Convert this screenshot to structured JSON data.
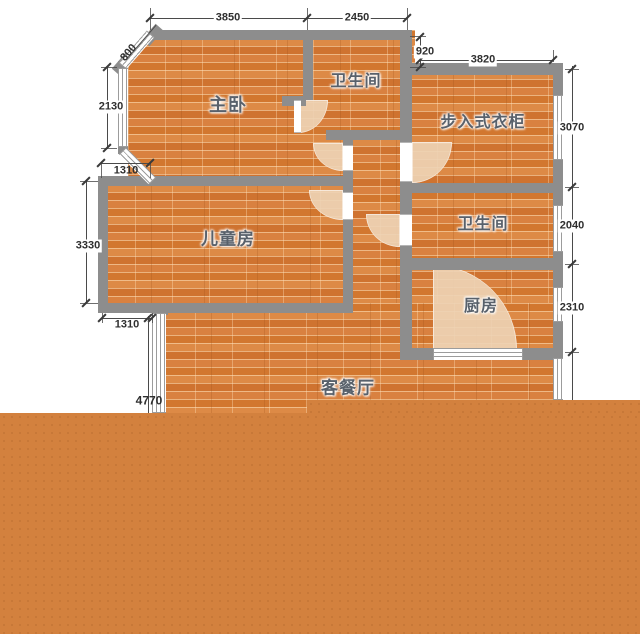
{
  "rooms": {
    "master_bedroom": "主卧",
    "bath_top": "卫生间",
    "closet": "步入式衣柜",
    "kids_room": "儿童房",
    "bath_mid": "卫生间",
    "kitchen": "厨房",
    "living_dining": "客餐厅"
  },
  "dimensions": {
    "top_left": "3850",
    "top_right": "2450",
    "right_offset": "920",
    "closet_width": "3820",
    "closet_height": "3070",
    "bath_height": "2040",
    "kitchen_height": "2310",
    "chamfer_window": "800",
    "master_window": "2130",
    "kids_top_offset": "1310",
    "kids_height": "3330",
    "kids_bottom_offset": "1310",
    "living_height": "4770"
  },
  "colors": {
    "wall": "#8d8d8d",
    "floor_base": "#d6813f",
    "door_arc": "#eed2b4",
    "overlay_orange": "#d3813e",
    "dim_line": "#4a4a4a",
    "dim_text": "#2f2f2f",
    "room_label": "#59616b",
    "background": "#ffffff"
  }
}
